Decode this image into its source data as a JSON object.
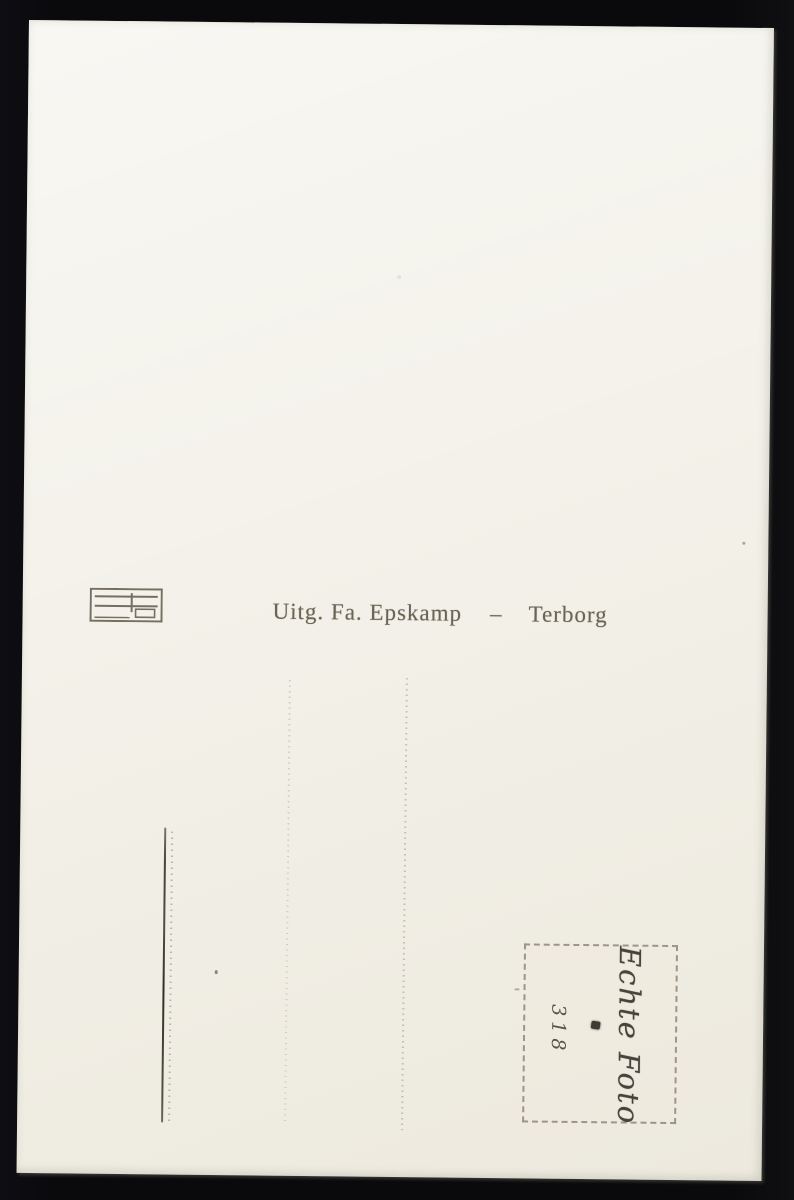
{
  "postcard": {
    "imprint": {
      "publisher": "Uitg. Fa. Epskamp",
      "separator": "–",
      "city": "Terborg"
    },
    "stamp_box": {
      "brand": "Echte Foto",
      "number": "318"
    },
    "icons": {
      "publisher_logo": "publisher-logo-mark"
    },
    "colors": {
      "background": "#0a0a0c",
      "card": "#f3f1e9",
      "ink": "#6a6455",
      "stamp_ink": "#46443c"
    }
  }
}
